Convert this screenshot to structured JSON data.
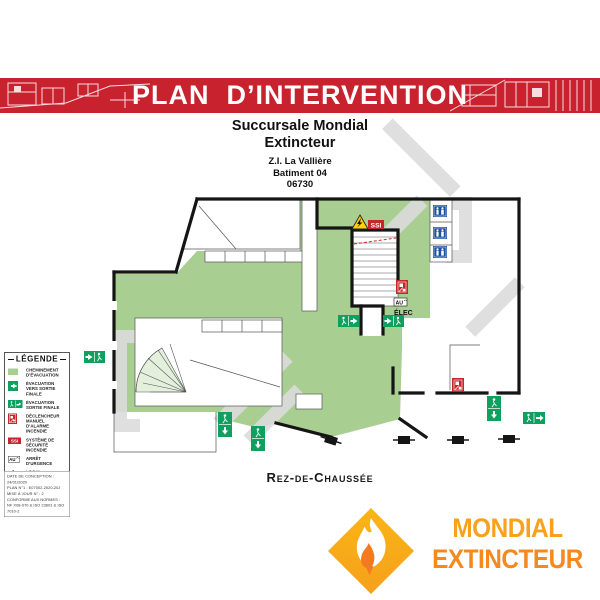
{
  "banner": {
    "title": "PLAN  D’INTERVENTION",
    "bg_color": "#C8222F"
  },
  "site": {
    "line1": "Succursale Mondial",
    "line2": "Extincteur",
    "address": "Z.I. La Vallière",
    "building": "Batiment 04",
    "postal_code": "06730"
  },
  "plan": {
    "floor_label": "Rez-de-Chaussée",
    "annotations": {
      "ssi": "SSI",
      "au": "AU",
      "elec": "ÉLEC"
    }
  },
  "legend": {
    "title": "LÉGENDE",
    "items": [
      {
        "icon": "evacuation-path-swatch",
        "label": "CHEMINEMENT D’ÉVACUATION"
      },
      {
        "icon": "exit-arrow-icon",
        "label": "ÉVACUATION VERS SORTIE FINALE"
      },
      {
        "icon": "exit-man-arrow-icon",
        "label": "ÉVACUATION SORTIE FINALE"
      },
      {
        "icon": "manual-call-point-icon",
        "label": "DÉCLENCHEUR MANUEL D’ALARME INCENDIE"
      },
      {
        "icon": "ssi-icon",
        "label": "SYSTÈME DE SÉCURITÉ INCENDIE"
      },
      {
        "icon": "emergency-stop-icon",
        "label": "ARRÊT D’URGENCE"
      },
      {
        "icon": "electrical-room-icon",
        "label": "LOCAL ÉLECTRIQUE / TRANSFO / TGBT"
      },
      {
        "icon": "toilets-icon",
        "label": "SANITAIRES H/F"
      }
    ]
  },
  "info_box": {
    "lines": [
      "DATE DE CONCEPTION : 24/01/2020",
      "PLAN N°1 : E07002-2020-20J",
      "MISE À JOUR N° : 2",
      "CONFORME AUX NORMES :",
      "NF X08-070 & ISO 23601 & ISO 7010-2"
    ]
  },
  "logo": {
    "line1": "MONDIAL",
    "line2": "EXTINCTEUR"
  },
  "colors": {
    "banner_red": "#C8222F",
    "evacuation_green": "#A9CE92",
    "exit_green": "#0FA05F",
    "alarm_red": "#C4262B",
    "sanitary_blue": "#1E4FA1",
    "warning_yellow": "#FFD200",
    "logo_orange": "#F9A11D",
    "flame_orange": "#F4791F",
    "wall_black": "#151515"
  }
}
